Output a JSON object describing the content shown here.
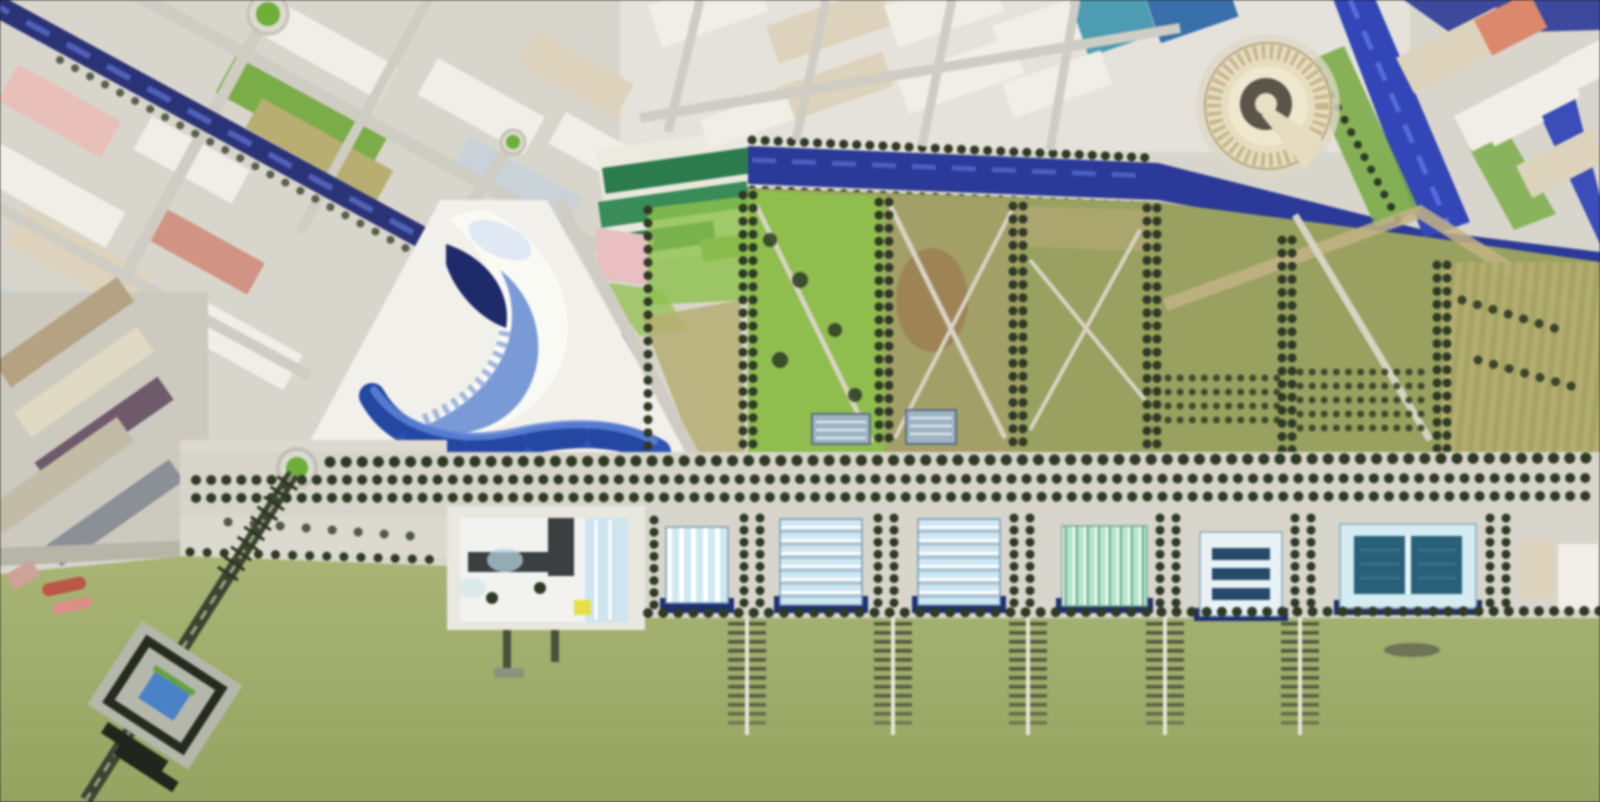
{
  "scene": {
    "type": "aerial-masterplan-rendering",
    "description": "Blurred aerial rendering of a riverside urban master plan: dense city fabric and a navy canal to the north, a circular arena, a white wave-roofed pavilion on a triangular plaza with a curved blue water channel, six tree-edged park blocks, a tree-lined promenade, a row of striped exhibition halls and a pool pavilion, five finger piers and a diagonal pier with a viewing platform reaching into a green waterfront"
  },
  "features": [
    {
      "name": "navy-canal-diagonal"
    },
    {
      "name": "north-canal"
    },
    {
      "name": "winding-river"
    },
    {
      "name": "arena-rotunda"
    },
    {
      "name": "wave-pavilion"
    },
    {
      "name": "plaza-water-channel"
    },
    {
      "name": "central-plaza"
    },
    {
      "name": "park-blocks"
    },
    {
      "name": "tree-promenade"
    },
    {
      "name": "exhibition-pavilions"
    },
    {
      "name": "pool-pavilion"
    },
    {
      "name": "museum-building"
    },
    {
      "name": "finger-piers"
    },
    {
      "name": "south-pier-platform"
    },
    {
      "name": "waterfront-lawn"
    },
    {
      "name": "industrial-docks"
    },
    {
      "name": "roundabouts"
    },
    {
      "name": "greenhouse-rows"
    },
    {
      "name": "orchard-plots"
    },
    {
      "name": "boats"
    }
  ],
  "counts": {
    "exhibition_pavilions": 6,
    "finger_piers": 5,
    "park_blocks": 6,
    "roundabouts": 3,
    "maintenance_sheds": 2,
    "small_boats": 3
  },
  "palette": {
    "lawn": "#a9b478",
    "lawnDeep": "#95a464",
    "pavement": "#d8d6cc",
    "pavementLight": "#e9e7df",
    "esplanade": "#dcdad0",
    "street": "#cfcdc3",
    "navyCanal": "#2c3374",
    "canalWater": "#2c3a94",
    "riverBlue": "#3346b2",
    "riverStreak": "#5e74e0",
    "waterCurve": "#2f55b0",
    "waterCurveDeep": "#1d3a8c",
    "waterCurveLight": "#5f84d4",
    "treeDark": "#2f3a26",
    "bankGreen": "#7cab4c",
    "roundaboutGreen": "#6fae3e",
    "parkOlive": "#98a162",
    "parkGreen": "#8fbf51",
    "parkTan": "#a3a06a",
    "parkBrown": "#9b7d52",
    "parkPath": "#d8d4c6",
    "orchardKhaki": "#b7ae74",
    "orchardOlive": "#a6a468",
    "trackTan": "#c2b387",
    "blockWhite": "#f0eee6",
    "blockBeige": "#ddd3bd",
    "blockPink": "#e6c0ba",
    "blockTerracotta": "#cf9484",
    "blockBlueGrey": "#c8d2d8",
    "tealRoof": "#4f9bb0",
    "blueRoof": "#3b6fa8",
    "salmonRoof": "#d9896f",
    "plazaWhite": "#f1f0ea",
    "waveDarkBlue": "#1f2a66",
    "waveBandBlue": "#6c8fd0",
    "waveLightBlue": "#dce6f2",
    "pinkBldg": "#e7bfc2",
    "arenaCream": "#e6dcc0",
    "arenaRing": "#c3b58f",
    "arenaCourt": "#595549",
    "hallRoof": "#cfe8f2",
    "hallStripeGrey": "#a9c3d2",
    "mintRoof": "#b9e6cf",
    "mintDeep": "#74b597",
    "pavilionBase": "#1e2f6e",
    "poolTeal": "#2a6076",
    "poolDeck": "#d6ecf2",
    "barNavy": "#274a68",
    "museumDeck": "#e8e7e0",
    "museumWhite": "#f2f3f0",
    "museumDark": "#3a3f42",
    "museumBlue": "#cfe4ee",
    "accentYellow": "#e6df4e",
    "industrialTan": "#b3a284",
    "industrialBeige": "#e0d9c4",
    "industrialMaroon": "#6e5a6b",
    "dockGrey": "#b7b5a9",
    "pierSpine": "#e8e6da",
    "pierRung": "#3f4636",
    "pierDark": "#3d4531",
    "platformGrey": "#b4b7ab",
    "platformFrame": "#262b20",
    "platformBlue": "#4c82c4",
    "boatRed": "#b65848",
    "boatPink": "#d98f86",
    "boatGrey": "#6f7458",
    "shedBlueGrey": "#9fb3c2",
    "greenhouseGreen": "#2f7a4e",
    "greenhouseLight": "#3c8a58"
  }
}
